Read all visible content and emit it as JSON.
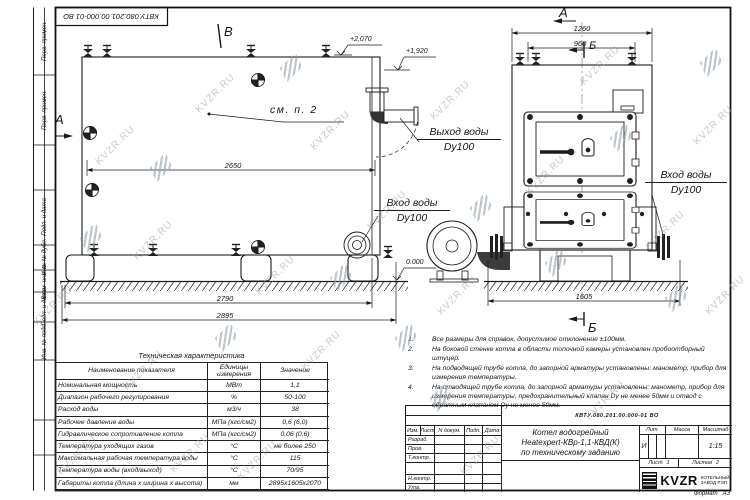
{
  "doc_number": "КВТУ.080.201.00.000-01 ВО",
  "watermark": {
    "text": "KVZR.RU"
  },
  "frame": {
    "stamps": [
      "Перв. примен.",
      "Перв. примен.",
      "Подп. и дата",
      "Инв. № дубл.",
      "Взам. инв. №",
      "Подп. и дата",
      "Инв. № подл."
    ]
  },
  "drawing": {
    "markers": {
      "a": "А",
      "b": "Б",
      "v": "В"
    },
    "see_note": "см. п. 2",
    "labels": {
      "outlet": "Выход воды",
      "inlet": "Вход воды",
      "dn": "Dy100"
    },
    "elevations": {
      "top": "+2,070",
      "mid": "+1,920",
      "zero": "0.000"
    },
    "dims": {
      "d2650": "2650",
      "d2790": "2790",
      "d2895": "2895",
      "d1260": "1260",
      "d960": "960",
      "d1605": "1605"
    }
  },
  "tech_table": {
    "title": "Техническая характеристика",
    "headers": [
      "Наименование показателя",
      "Единицы измерения",
      "Значение"
    ],
    "rows": [
      [
        "Номинальная мощность",
        "МВт",
        "1,1"
      ],
      [
        "Диапазон рабочего регулирования",
        "%",
        "50-100"
      ],
      [
        "Расход воды",
        "м3/ч",
        "38"
      ],
      [
        "Рабочее давление воды",
        "МПа (кгс/см2)",
        "0,6 (6,0)"
      ],
      [
        "Гидравлическое сопротивление котла",
        "МПа (кгс/см2)",
        "0,06 (0,6)"
      ],
      [
        "Температура уходящих газов",
        "°С",
        "не более 250"
      ],
      [
        "Максимальная рабочая температура воды",
        "°С",
        "115"
      ],
      [
        "Температура воды (вход/выход)",
        "°С",
        "70/95"
      ],
      [
        "Габариты котла (длина х ширина х высота)",
        "мм",
        "2895х1605х2070"
      ]
    ]
  },
  "notes": {
    "items": [
      {
        "num": "1.",
        "text": "Все размеры для справок, допустимое отклонение ±100мм."
      },
      {
        "num": "2.",
        "text": "На боковой стенке котла в области топочной камеры установлен пробоотборный штуцер."
      },
      {
        "num": "3.",
        "text": "На подводящей трубе котла, до запорной арматуры установлены: манометр, прибор для измерения температуры."
      },
      {
        "num": "4.",
        "text": "На отводящей трубе котла, до запорной арматуры установлены: манометр, прибор для измерения температуры, предохранительный клапан Dу не менее 50мм и отвод с обратным клапаном Dу не менее 50мм."
      }
    ]
  },
  "title_block": {
    "header_cols": [
      "Изм.",
      "Лист",
      "N докум.",
      "Подп.",
      "Дата"
    ],
    "roles": [
      "Разраб.",
      "Пров.",
      "Т.контр.",
      "Н.контр.",
      "Утв."
    ],
    "name_lines": [
      "Котел водогрейный",
      "Heatexpert-КВр-1,1-КВД(К)",
      "по техническому заданию"
    ],
    "lit_label": "Лит.",
    "mass_label": "Масса",
    "scale_label": "Масштаб",
    "lit_value": "И",
    "scale_value": "1:15",
    "sheet_label": "Лист",
    "sheet_value": "1",
    "sheets_label": "Листов",
    "sheets_value": "2",
    "logo_text": "KVZR",
    "company_lines": [
      "КОТЕЛЬНЫЙ",
      "ЗАВОД РЭП"
    ],
    "format_label": "Формат",
    "format_value": "А3"
  }
}
